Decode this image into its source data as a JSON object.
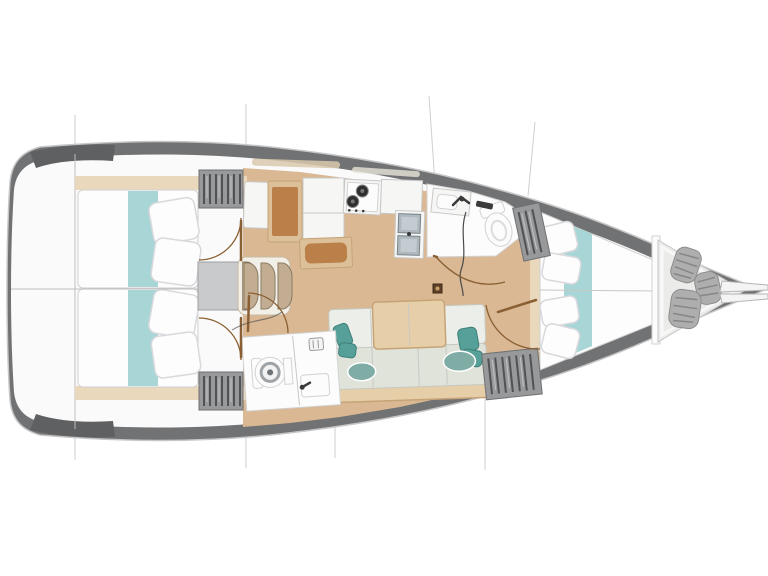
{
  "figure": {
    "kind": "sailing-yacht-interior-floor-plan",
    "view": "top-down",
    "orientation": "bow-right-stern-left"
  },
  "colors": {
    "background": "#ffffff",
    "hullBand": "#717274",
    "hullBandDark": "#5f6062",
    "hullOutline": "#c6c6c6",
    "deckWhite": "#fafafa",
    "sectionLine": "#cfcfcf",
    "innerLine": "#bdbdbd",
    "floorWood": "#d9b893",
    "floorTrim": "#e9d8bc",
    "bedWhite": "#fdfdfd",
    "bedOutline": "#d0d0d0",
    "pillowShade": "#d9d9dd",
    "tealFabric": "#a8d5d6",
    "tealPillow": "#57a09a",
    "tealPillowEdge": "#3f7f78",
    "tealHump": "#7fada6",
    "wardrobeGray": "#98999b",
    "wardrobeEdge": "#6f7072",
    "wardrobeStripe": "#515254",
    "wardrobeLight": "#c2c3c5",
    "counterWhite": "#f6f6f5",
    "counterEdge": "#c9c9c9",
    "woodFrame": "#dcc09a",
    "woodBrown": "#bb7f49",
    "tableWood": "#e6cfa8",
    "tableEdge": "#c6a377",
    "cushionLight": "#eceee9",
    "cushionSeat": "#e0e3da",
    "cushionEdge": "#c6c9c2",
    "sinkSteel": "#aeb8bd",
    "sinkSteelDark": "#78838a",
    "sinkInner": "#c3ccd0",
    "burnerDark": "#2f2f2f",
    "stepsShell": "#f2efe7",
    "stepsEdge": "#c9bba1",
    "stepsArch": "#c2ad92",
    "stepsArchEdge": "#8a7a64",
    "landingGray": "#c9cacb",
    "landingEdge": "#9fa0a2",
    "fixtureWhite": "#fcfcfd",
    "fixtureEdge": "#d2d2d2",
    "toiletRing": "#9fa3a6",
    "faucetDark": "#3a3a3a",
    "hoseDark": "#4a4a4a",
    "doorArc": "#8a5f33",
    "fenderGray": "#aeaeae",
    "fenderEdge": "#8d8d8d",
    "fenderRidge": "#868686",
    "lockerFloor": "#ebebe9",
    "mastDark": "#5d4026",
    "bandHighlightTan": "#d9c9ad",
    "bandHighlightGray": "#e8e4da"
  },
  "components": {
    "hull": [
      "gunwale-band",
      "transom",
      "bowsprit"
    ],
    "section_lines": 7,
    "aft_cabins": [
      {
        "name": "aft-cabin-port",
        "items": [
          "double-bed",
          "teal-runner",
          "pillows"
        ]
      },
      {
        "name": "aft-cabin-starboard",
        "items": [
          "double-bed",
          "teal-runner",
          "pillows"
        ]
      }
    ],
    "wardrobes": 4,
    "companionway": {
      "steps": 3,
      "landing": 1
    },
    "galley": {
      "burners": 2,
      "sinks": 2,
      "counters": 3,
      "wood_lockers": 2
    },
    "salon": {
      "settee_sections": 3,
      "teal_pillows": 4,
      "seat_cushions": 2,
      "table": 1
    },
    "heads": [
      {
        "name": "aft-head",
        "items": [
          "toilet",
          "sink",
          "faucet",
          "vent"
        ]
      },
      {
        "name": "forward-head",
        "items": [
          "toilet",
          "sink",
          "faucet",
          "shower"
        ]
      }
    ],
    "forward_cabin": {
      "name": "v-berth",
      "items": [
        "double-bed",
        "teal-runner",
        "pillows"
      ]
    },
    "bow_locker": {
      "fenders": 3
    },
    "mast_post": 1,
    "door_swings": 5
  }
}
